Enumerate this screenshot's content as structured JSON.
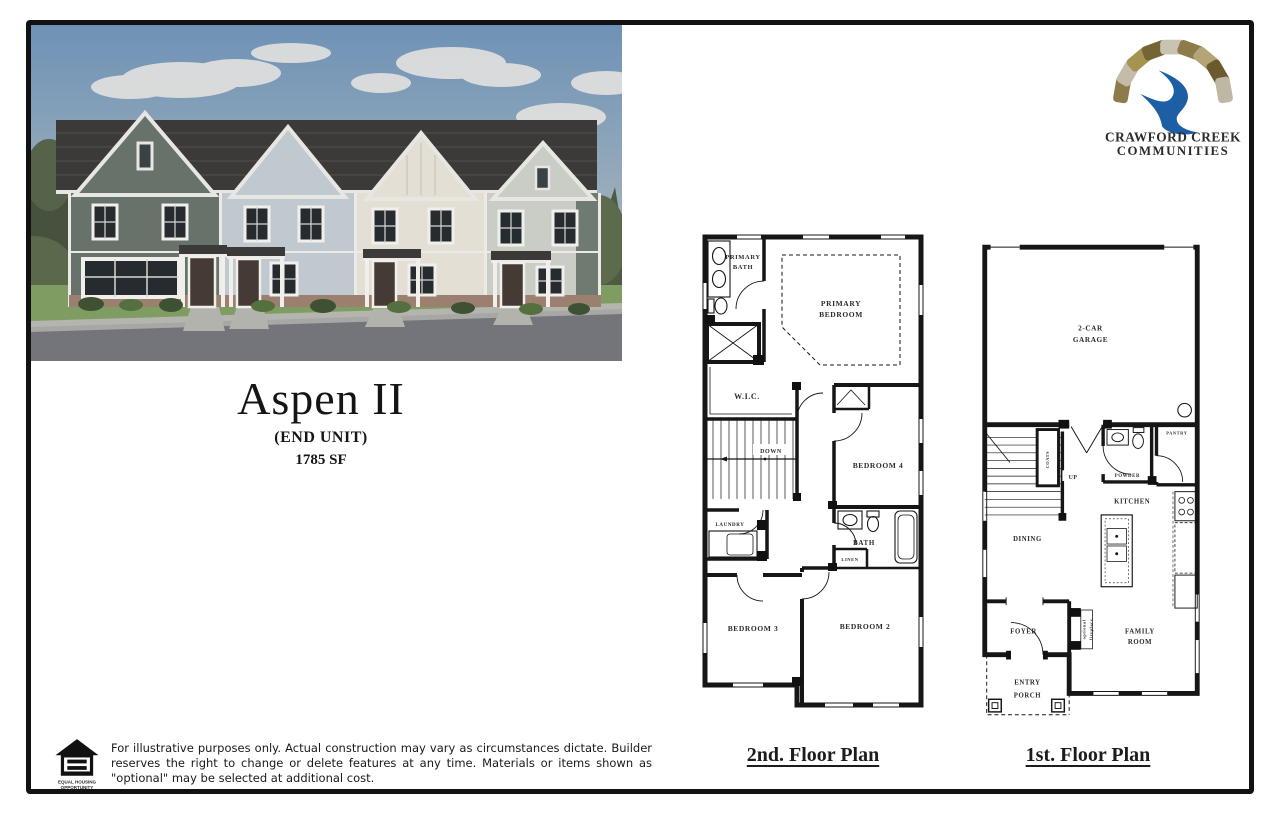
{
  "title_block": {
    "name": "Aspen II",
    "unit_type": "(END UNIT)",
    "square_feet": "1785 SF"
  },
  "logo": {
    "line1": "CRAWFORD CREEK",
    "line2": "COMMUNITIES"
  },
  "second_floor": {
    "caption": "2nd. Floor Plan",
    "rooms": {
      "primary_bath": [
        "PRIMARY",
        "BATH"
      ],
      "primary_bedroom": [
        "PRIMARY",
        "BEDROOM"
      ],
      "wic": "W.I.C.",
      "down": "DOWN",
      "bedroom_4": "BEDROOM 4",
      "laundry": "LAUNDRY",
      "bath": "BATH",
      "linen": "LINEN",
      "bedroom_3": "BEDROOM 3",
      "bedroom_2": "BEDROOM 2"
    }
  },
  "first_floor": {
    "caption": "1st. Floor Plan",
    "rooms": {
      "garage": [
        "2-CAR",
        "GARAGE"
      ],
      "coats": "COATS",
      "up": "UP",
      "powder": "POWDER",
      "pantry": "PANTRY",
      "kitchen": "KITCHEN",
      "dining": "DINING",
      "foyer": "FOYER",
      "optional_fireplace": [
        "optional",
        "fireplace"
      ],
      "family_room": [
        "FAMILY",
        "ROOM"
      ],
      "entry_porch": [
        "ENTRY",
        "PORCH"
      ]
    }
  },
  "disclaimer": {
    "eho_label": [
      "EQUAL HOUSING",
      "OPPORTUNITY"
    ],
    "text": "For illustrative purposes only. Actual construction may vary as circumstances dictate. Builder reserves the right to change or delete features at any time. Materials or items shown as \"optional\" may be selected at additional cost."
  },
  "palette": {
    "frame": "#121212",
    "sky": "#6e92b6",
    "roof": "#3b3a38",
    "unit1_siding": "#67726b",
    "unit2_siding": "#bfc9cf",
    "unit3_siding": "#e3dfd5",
    "unit4_siding": "#c9cdc6",
    "brick": "#9b8070",
    "lawn": "#7f9d63",
    "road": "#74757a",
    "logo_blue": "#1d5fa5",
    "logo_text": "#3d4f5c"
  }
}
